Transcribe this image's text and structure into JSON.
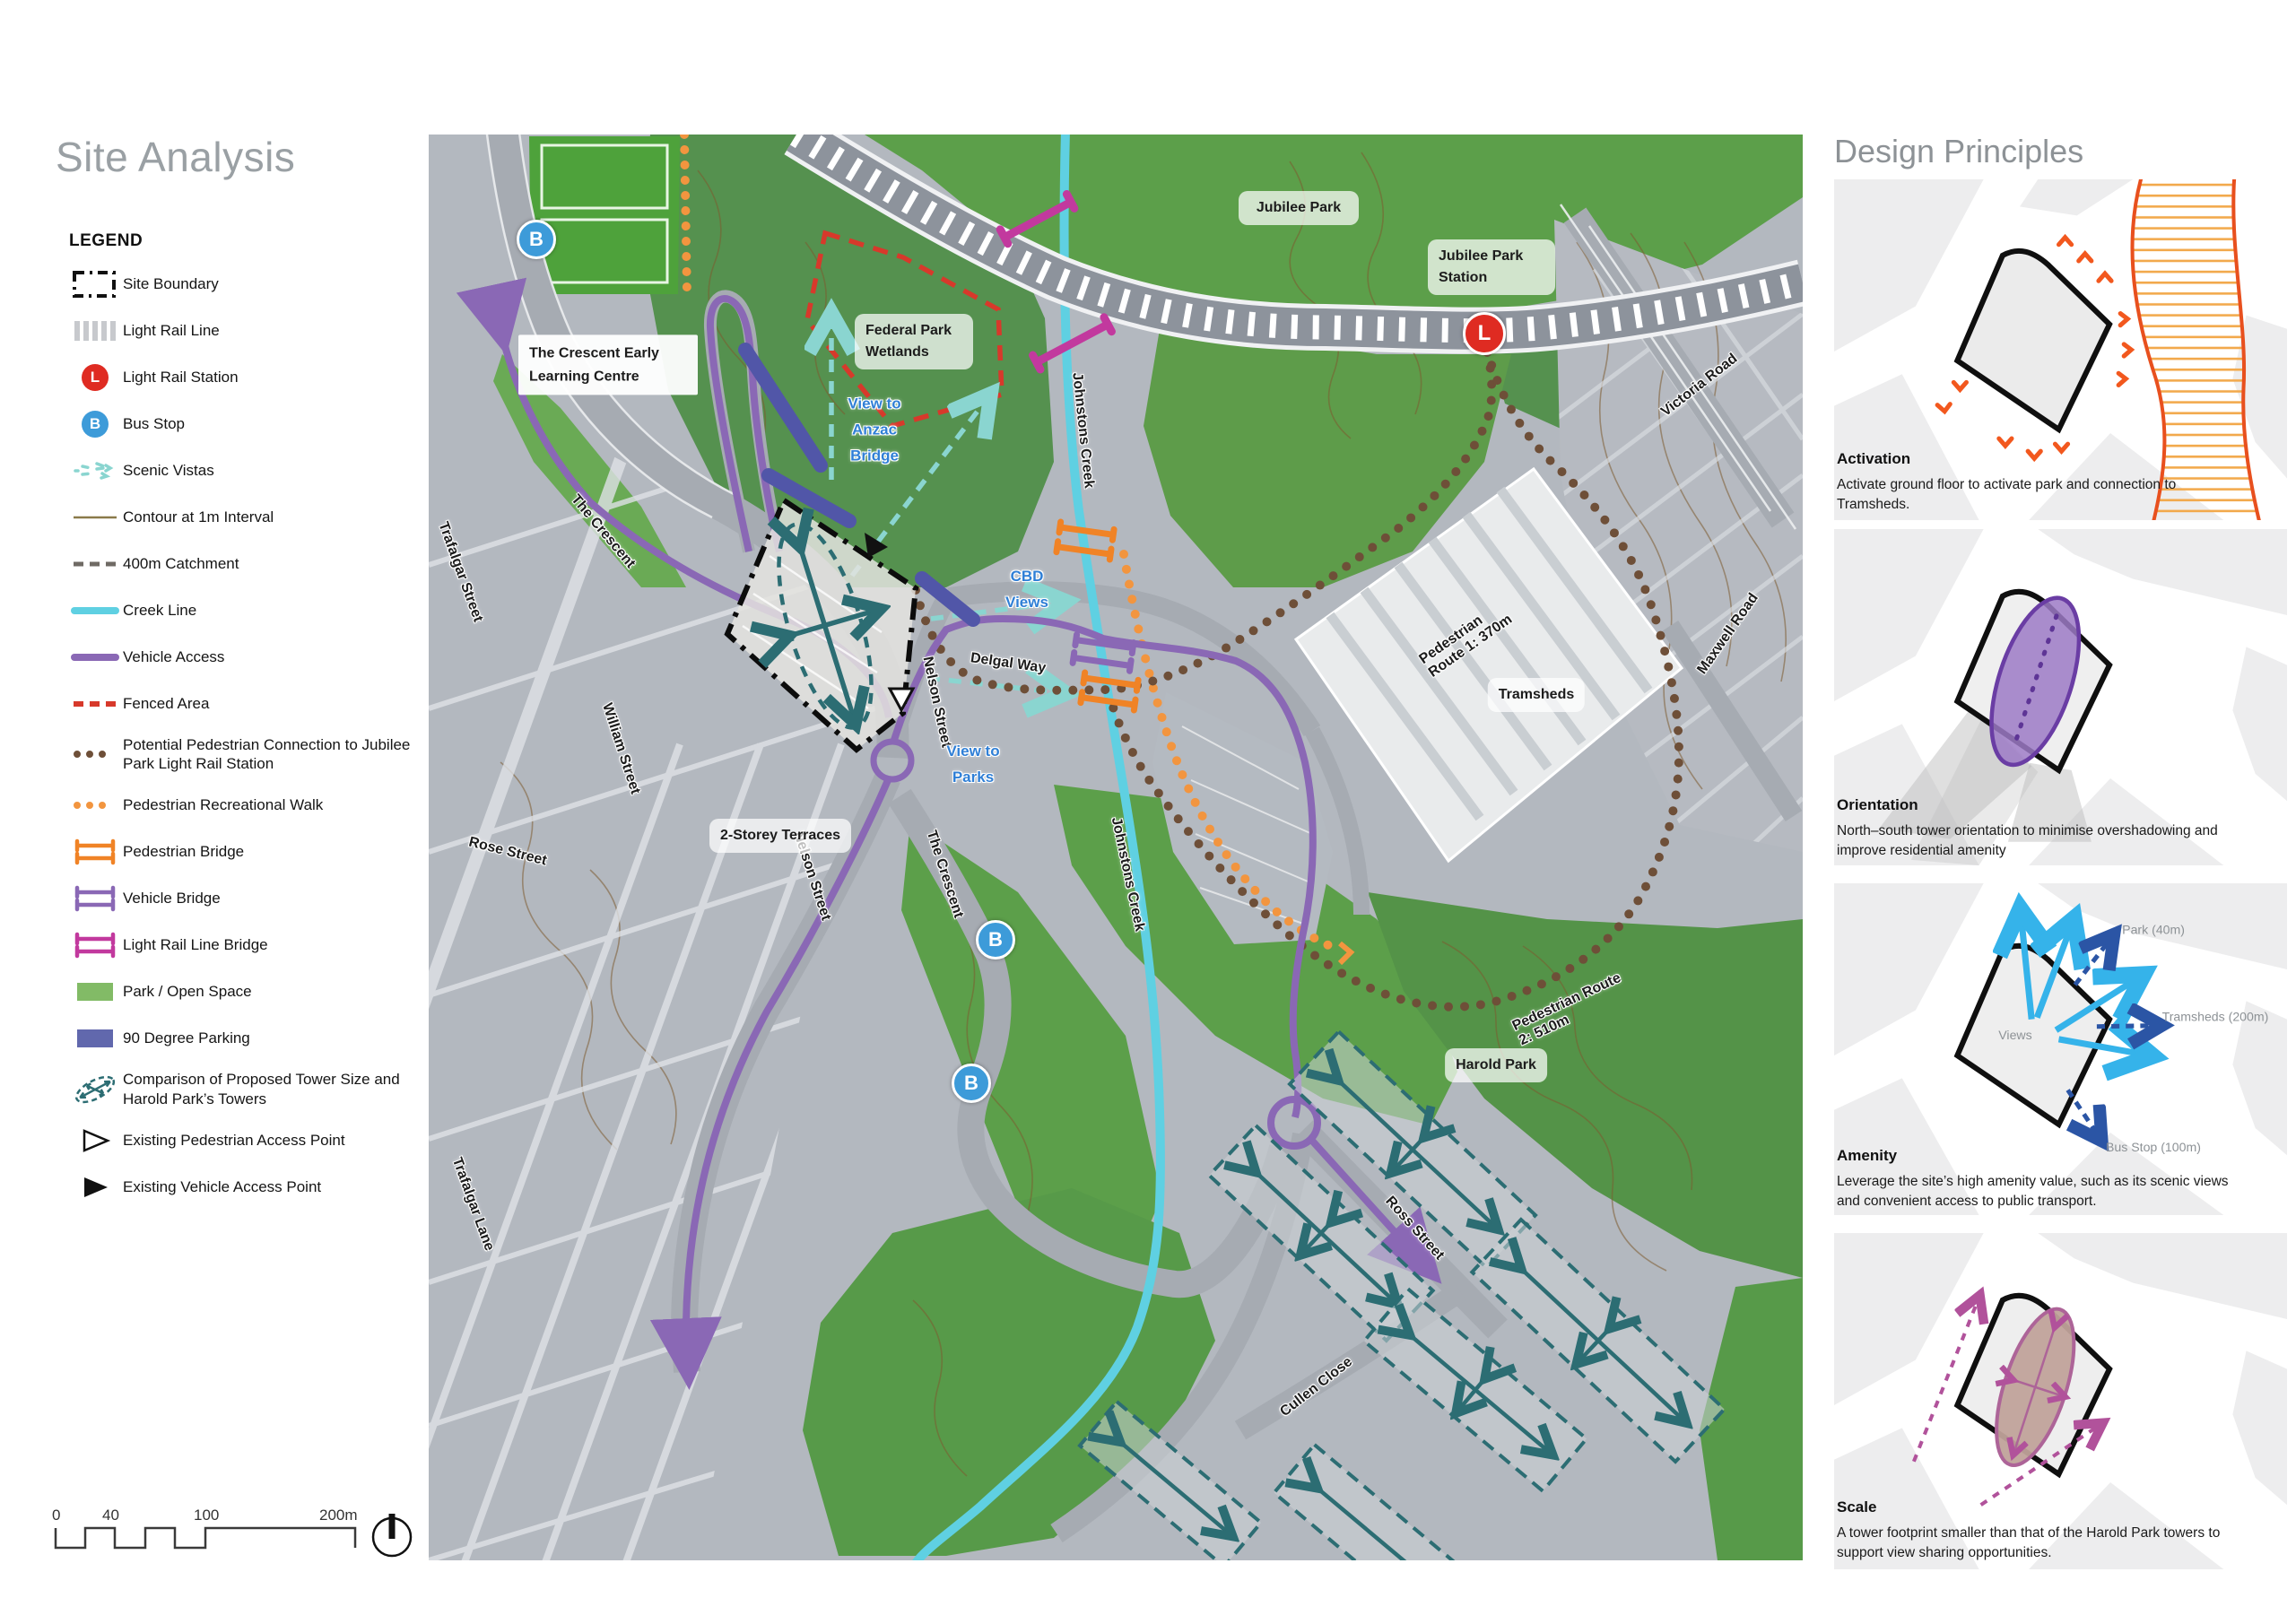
{
  "page": {
    "title": "Site Analysis"
  },
  "legend": {
    "heading": "LEGEND",
    "items": [
      {
        "label": "Site Boundary"
      },
      {
        "label": "Light Rail Line"
      },
      {
        "label": "Light Rail Station"
      },
      {
        "label": "Bus Stop"
      },
      {
        "label": "Scenic Vistas"
      },
      {
        "label": "Contour at 1m Interval"
      },
      {
        "label": "400m Catchment"
      },
      {
        "label": "Creek Line"
      },
      {
        "label": "Vehicle Access"
      },
      {
        "label": "Fenced Area"
      },
      {
        "label": "Potential Pedestrian Connection to Jubilee Park Light Rail Station"
      },
      {
        "label": "Pedestrian Recreational Walk"
      },
      {
        "label": "Pedestrian Bridge"
      },
      {
        "label": "Vehicle Bridge"
      },
      {
        "label": "Light Rail Line Bridge"
      },
      {
        "label": "Park / Open Space"
      },
      {
        "label": "90 Degree Parking"
      },
      {
        "label": "Comparison of Proposed Tower Size and Harold Park’s Towers"
      },
      {
        "label": "Existing Pedestrian Access Point"
      },
      {
        "label": "Existing Vehicle Access Point"
      }
    ]
  },
  "scalebar": {
    "ticks": [
      "0",
      "40",
      "100",
      "200m"
    ]
  },
  "map": {
    "markers": {
      "bus": "B",
      "rail": "L"
    },
    "labels": {
      "jubilee_park": "Jubilee Park",
      "jubilee_park_station": "Jubilee Park Station",
      "victoria_road": "Victoria Road",
      "maxwell_road": "Maxwell Road",
      "federal_park_wetlands": "Federal Park Wetlands",
      "view_to_anzac_bridge": "View to Anzac Bridge",
      "crescent_early_learning": "The Crescent Early Learning Centre",
      "the_crescent_upper": "The Crescent",
      "the_crescent_lower": "The Crescent",
      "trafalgar_street": "Trafalgar Street",
      "william_street": "William Street",
      "rose_street": "Rose Street",
      "nelson_street_upper": "Nelson Street",
      "nelson_street_lower": "Nelson Street",
      "delgal_way": "Delgal Way",
      "cbd_views": "CBD Views",
      "view_to_parks": "View to Parks",
      "two_storey_terraces": "2-Storey Terraces",
      "johnstons_creek_upper": "Johnstons Creek",
      "johnstons_creek_lower": "Johnstons Creek",
      "pedestrian_route_1": "Pedestrian Route 1:  370m",
      "tramsheds": "Tramsheds",
      "pedestrian_route_2": "Pedestrian Route 2:  510m",
      "harold_park": "Harold Park",
      "ross_street": "Ross Street",
      "cullen_close": "Cullen Close",
      "trafalgar_lane": "Trafalgar Lane"
    }
  },
  "principles": {
    "heading": "Design Principles",
    "items": [
      {
        "title": "Activation",
        "text": "Activate ground floor to activate park and connection to Tramsheds."
      },
      {
        "title": "Orientation",
        "text": "North–south tower orientation to minimise overshadowing and improve residential amenity"
      },
      {
        "title": "Amenity",
        "text": "Leverage the site’s high amenity value, such as its scenic views and convenient access to public transport."
      },
      {
        "title": "Scale",
        "text": "A tower footprint smaller than that of the Harold Park towers to support view sharing opportunities."
      }
    ],
    "amenity_labels": {
      "views": "Views",
      "park": "Park (40m)",
      "tramsheds": "Tramsheds (200m)",
      "bus_stop": "Bus Stop (100m)"
    }
  }
}
